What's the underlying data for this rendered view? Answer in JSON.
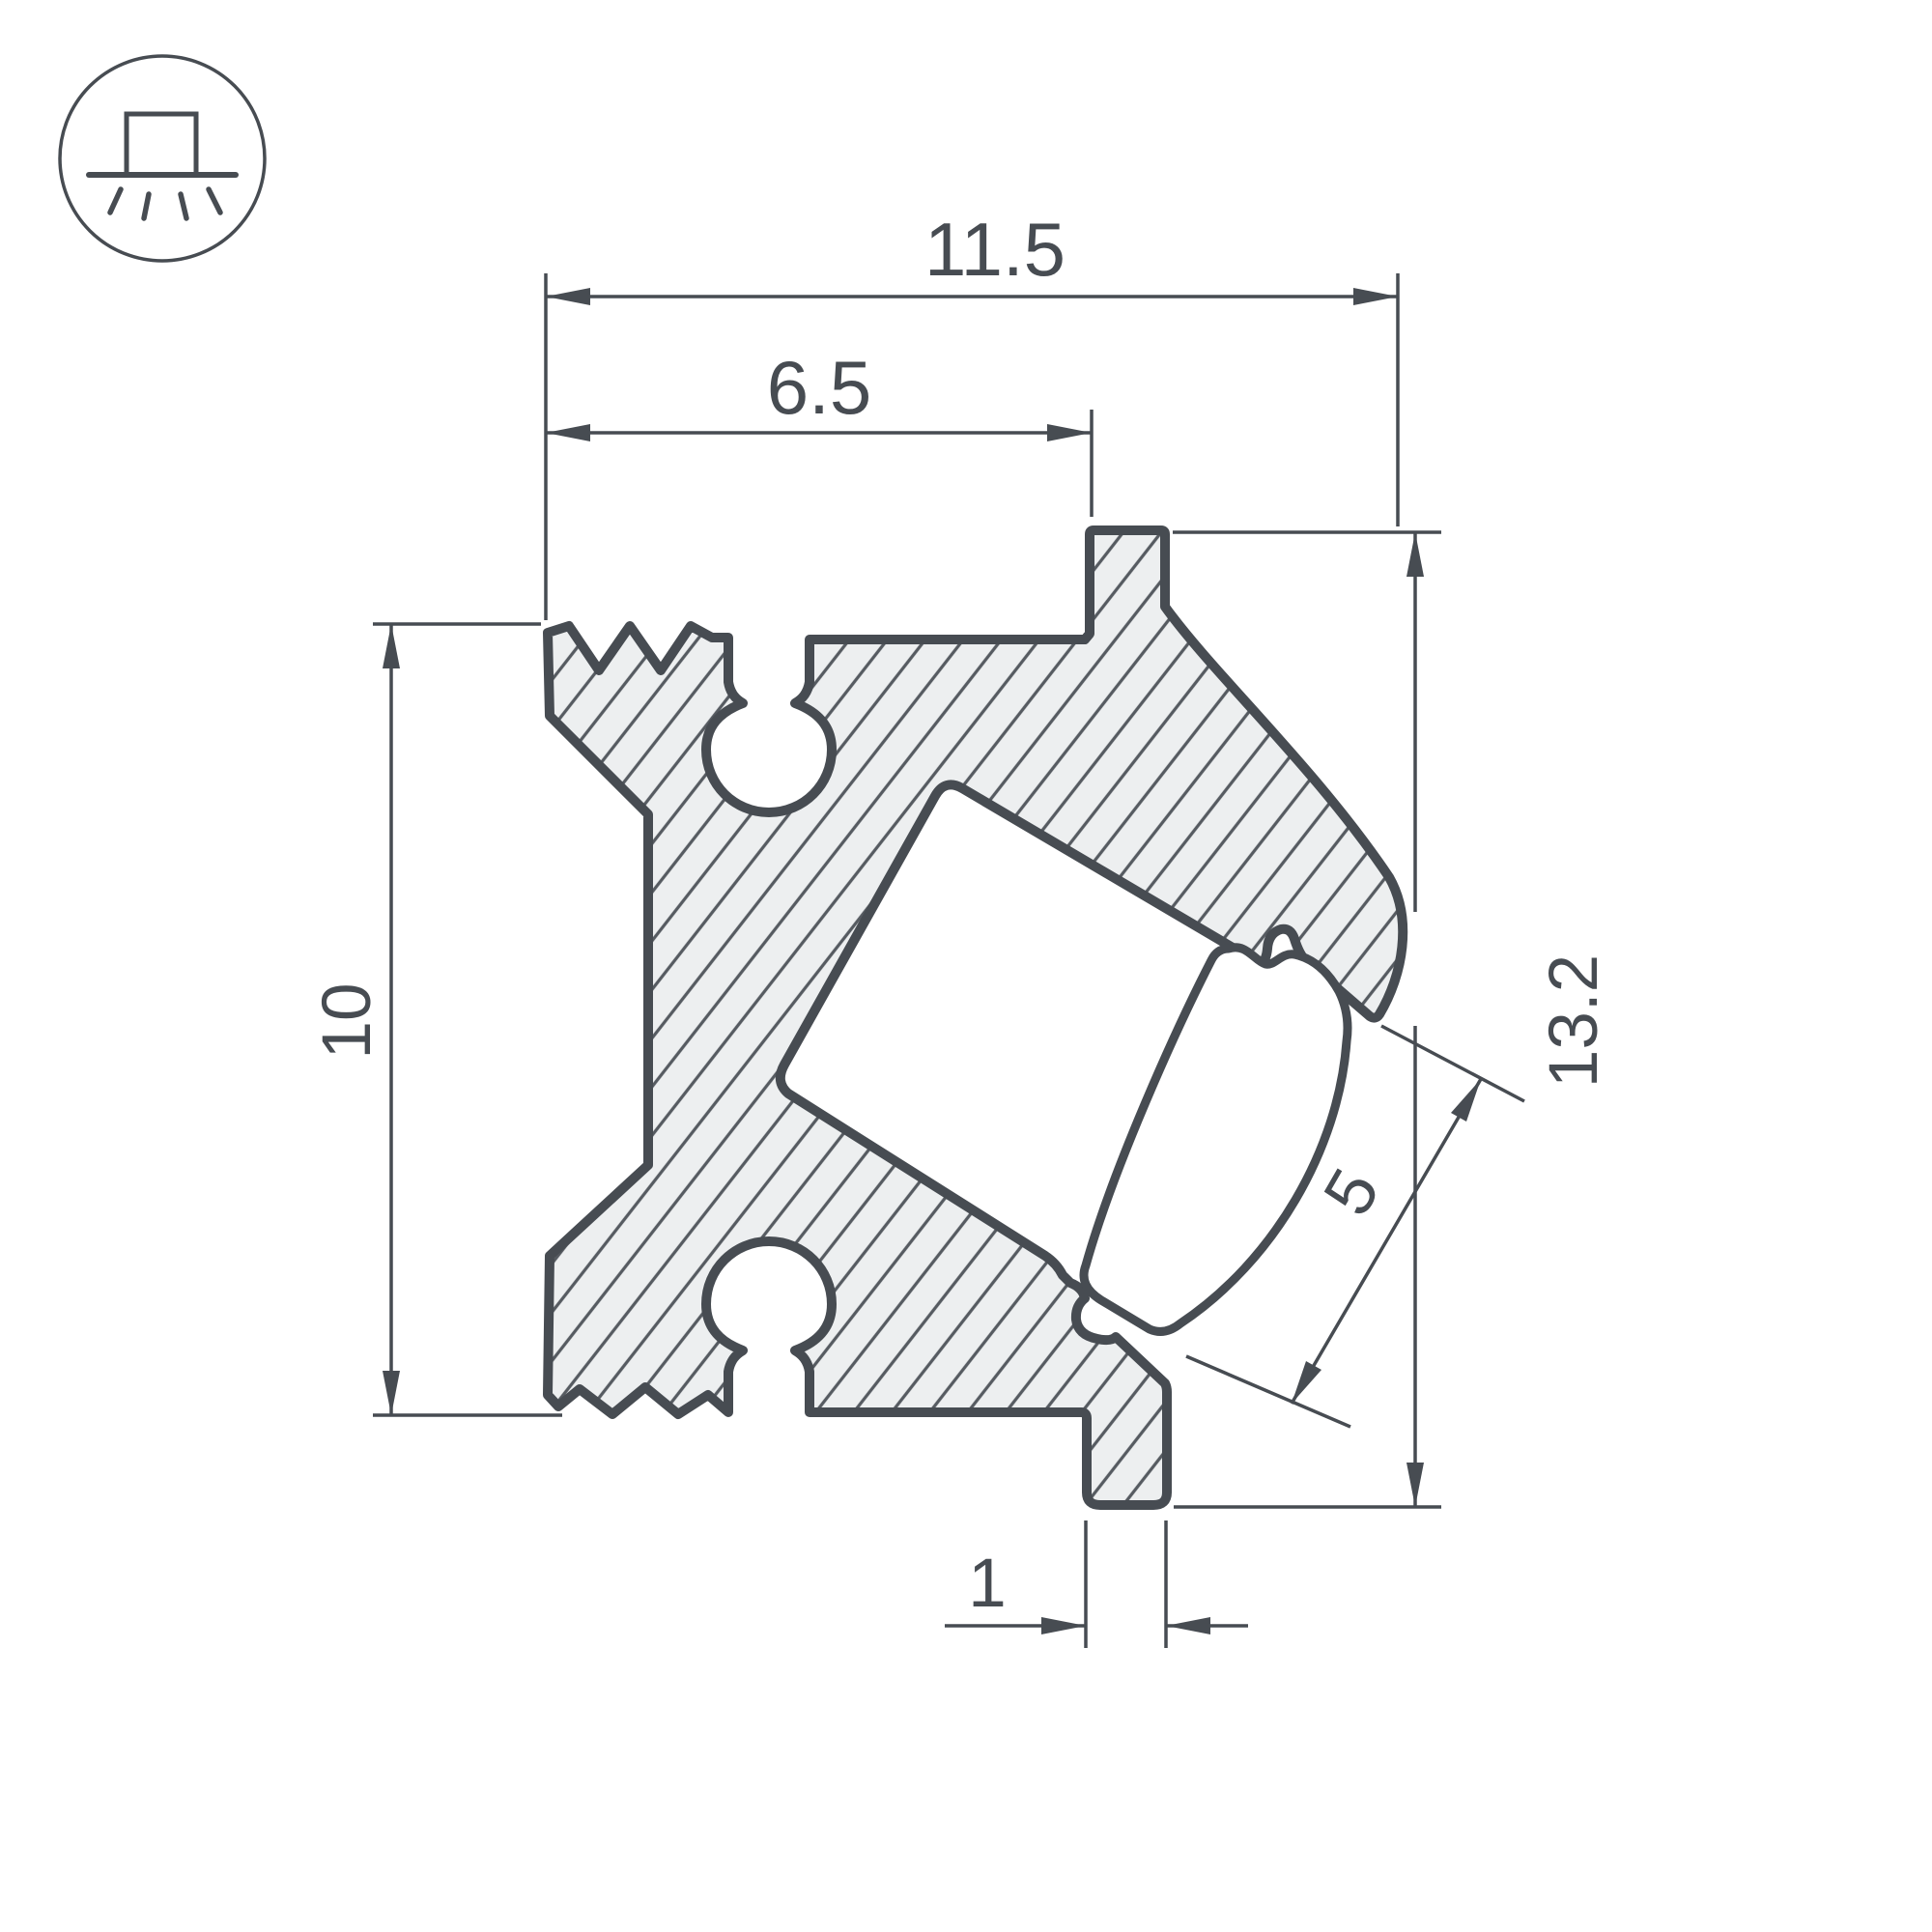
{
  "drawing": {
    "type": "technical cross-section drawing of an LED corner profile",
    "icon": {
      "name": "surface-mounted-light-icon"
    }
  },
  "dimensions": {
    "overall_width": {
      "label": "11.5"
    },
    "slot_offset": {
      "label": "6.5"
    },
    "body_height": {
      "label": "10"
    },
    "overall_height": {
      "label": "13.2"
    },
    "channel_opening": {
      "label": "5"
    },
    "tab_width": {
      "label": "1"
    }
  },
  "colors": {
    "line": "#474c52",
    "body_fill": "#edeff0",
    "hatch_line": "#565b61",
    "background": "#ffffff"
  }
}
